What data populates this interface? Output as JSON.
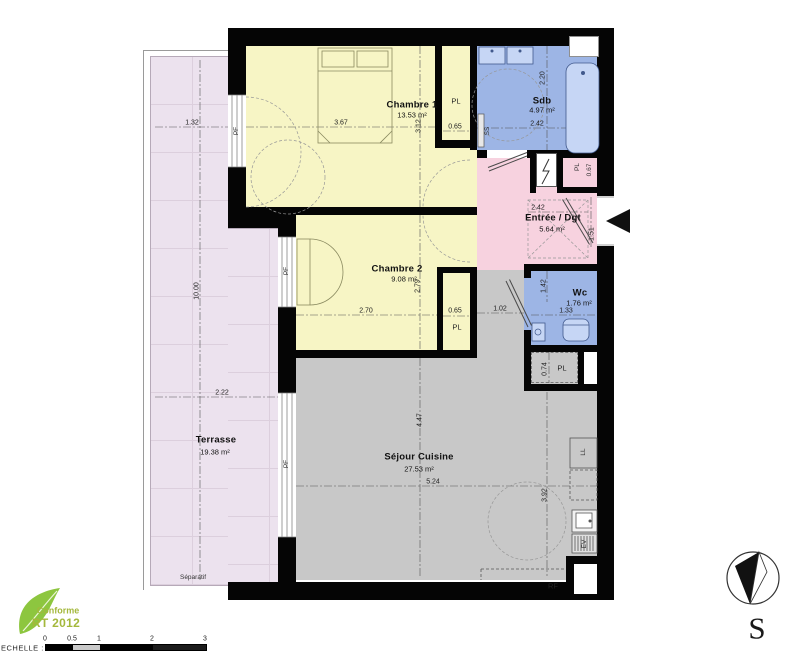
{
  "rooms": {
    "chambre1": {
      "name": "Chambre 1",
      "area": "13.53 m²"
    },
    "chambre2": {
      "name": "Chambre 2",
      "area": "9.08 m²"
    },
    "sdb": {
      "name": "Sdb",
      "area": "4.97 m²"
    },
    "entree": {
      "name": "Entrée / Dgt",
      "area": "5.64 m²"
    },
    "wc": {
      "name": "Wc",
      "area": "1.76 m²"
    },
    "sejour": {
      "name": "Séjour Cuisine",
      "area": "27.53 m²"
    },
    "terrasse": {
      "name": "Terrasse",
      "area": "19.38 m²",
      "separator": "Séparatif"
    }
  },
  "dimensions": {
    "chambre1_w": "3.67",
    "chambre1_h": "3.12",
    "chambre1_pl": "0.65",
    "sdb_h": "2.20",
    "sdb_w": "2.42",
    "entree_w": "2.42",
    "entree_door": "1.51",
    "entree_pl": "0.67",
    "chambre2_w": "2.70",
    "chambre2_h": "2.79",
    "chambre2_pl": "0.65",
    "wc_h": "1.42",
    "wc_w": "1.33",
    "wc_access": "1.02",
    "wc_pl": "0.74",
    "sejour_h": "4.47",
    "sejour_w": "5.24",
    "sejour_kitchen_h": "3.92",
    "terrasse_w1": "1.32",
    "terrasse_l": "10.00",
    "terrasse_w2": "2.22"
  },
  "fixtures": {
    "pl": "PL",
    "pf": "PF",
    "ss": "SS",
    "ll": "LL",
    "ev": "EV",
    "rf": "RF"
  },
  "compass": {
    "south": "S"
  },
  "logo": {
    "line1": "Conforme",
    "line2": "RT 2012",
    "text_color": "#a4b83c",
    "leaf_color": "#8dc63f"
  },
  "scale_bar": {
    "label": "ECHELLE :",
    "ticks": [
      "0",
      "0.5",
      "1",
      "2",
      "3"
    ]
  },
  "colors": {
    "wall": "#050505",
    "bedroom_yellow": "#f7f5c5",
    "wet_blue": "#9db5e5",
    "entry_pink": "#f7d2df",
    "living_gray": "#c8c8c8",
    "terrace_lavender": "#ece2ee",
    "fixture_blue": "#c6d6f5"
  }
}
